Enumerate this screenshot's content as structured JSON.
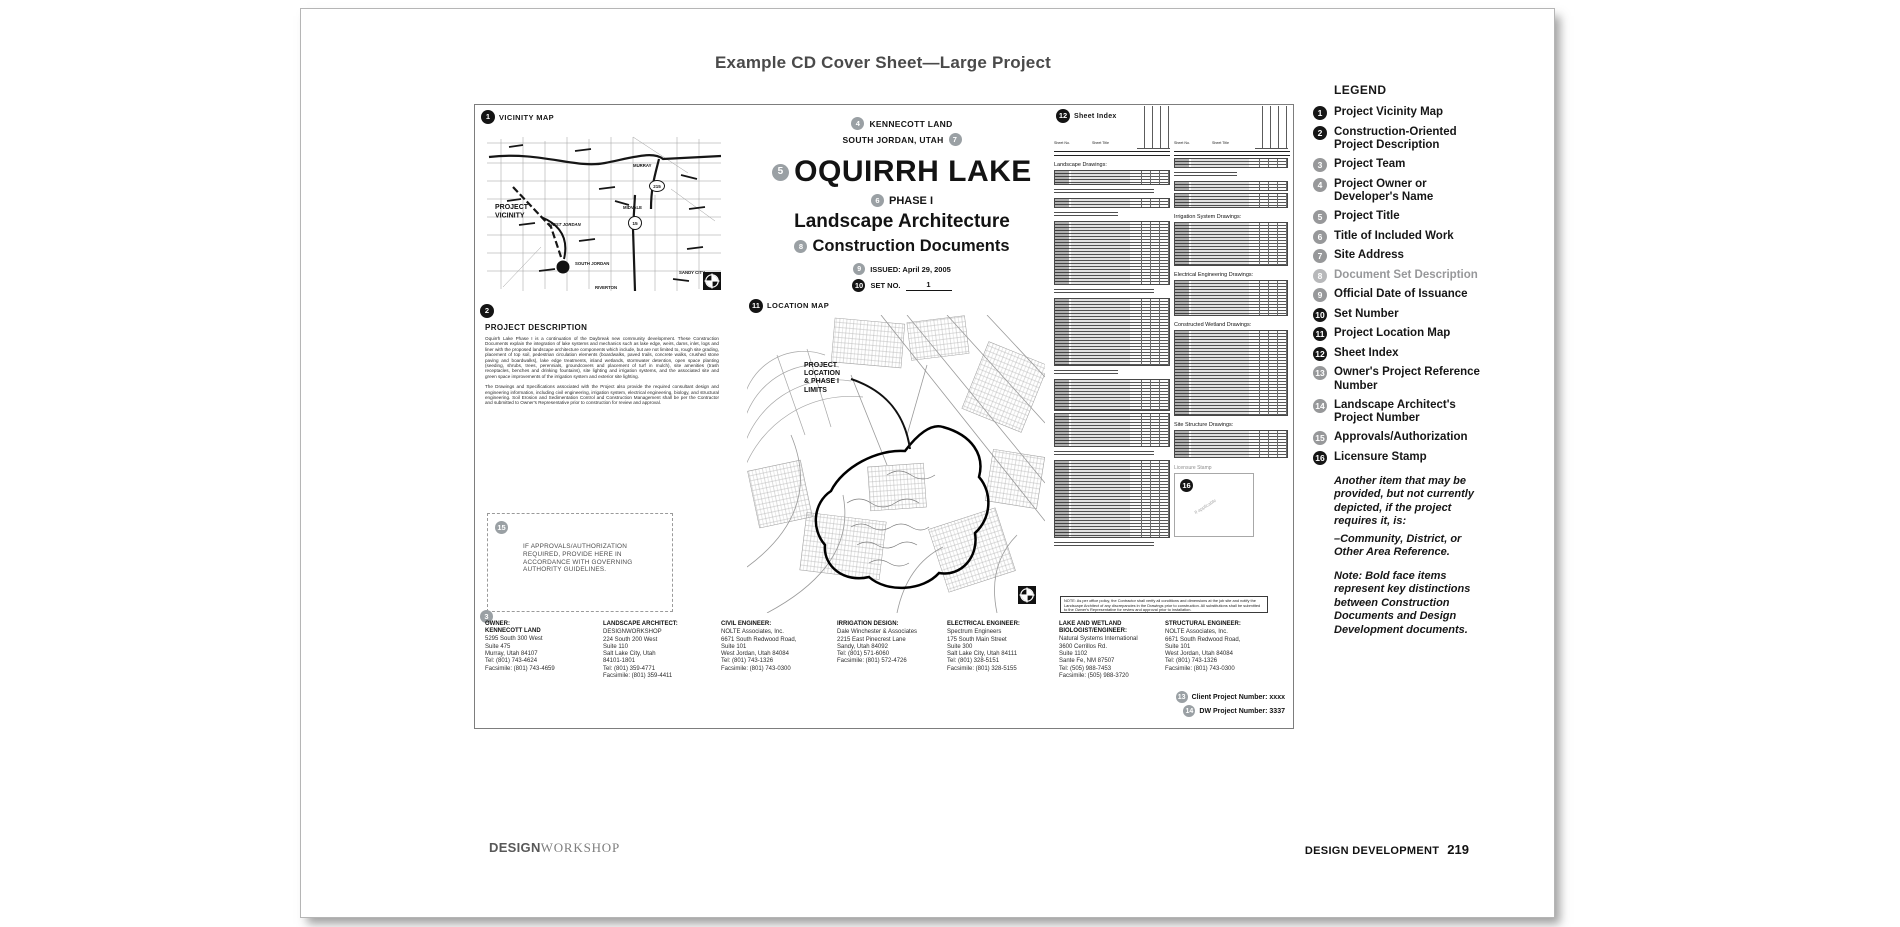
{
  "page_title": "Example CD Cover Sheet—Large Project",
  "sheet": {
    "vicinity": {
      "number": "1",
      "title": "VICINITY MAP",
      "callout": "PROJECT\nVICINITY",
      "labels": {
        "murray": "MURRAY",
        "midvale": "MIDVALE",
        "west_jordan": "WEST JORDAN",
        "south_jordan": "SOUTH JORDAN",
        "sandy_city": "SANDY CITY",
        "riverton": "RIVERTON",
        "route_215": "215",
        "route_15": "15"
      }
    },
    "description": {
      "number": "2",
      "title": "PROJECT DESCRIPTION",
      "para1": "Oquirrh Lake Phase I is a continuation of the Daybreak new community development. These Construction Documents explain the integration of lake systems and mechanics such as lake edge, weirs, dams, inlet, logs and liner with the proposed landscape architecture components which include, but are not limited to, rough site grading, placement of top soil, pedestrian circulation elements (boardwalks, paved trails, concrete walks, crushed stone paving and boardwalks), lake edge treatments, inland wetlands, stormwater detention, open space planting (seeding, shrubs, trees, perennials, groundcovers and placement of turf in mulch), site amenities (trash receptacles, benches and drinking fountains), site lighting and irrigation systems, and the associated site and green space improvements of the irrigation system and exterior site lighting.",
      "para2": "The Drawings and Specifications associated with the Project also provide the required consultant design and engineering information, including civil engineering, irrigation system, electrical engineering, biology, and structural engineering. Soil Erosion and Sedimentation Control and Construction Management shall be per the Contractor and submitted to Owner's Representative prior to construction for review and approval."
    },
    "title_block": {
      "owner_number": "4",
      "owner": "KENNECOTT LAND",
      "address": "SOUTH JORDAN, UTAH",
      "address_number": "7",
      "title_number": "5",
      "project_title": "OQUIRRH LAKE",
      "phase_number": "6",
      "phase": "PHASE I",
      "work_title": "Landscape Architecture",
      "set_desc_number": "8",
      "set_description": "Construction Documents",
      "issued_number": "9",
      "issued": "ISSUED: April 29, 2005",
      "set_no_number": "10",
      "set_no_label": "SET NO.",
      "set_no_value": "1"
    },
    "location_map": {
      "number": "11",
      "title": "LOCATION MAP",
      "callout": "PROJECT\nLOCATION\n& PHASE I\nLIMITS"
    },
    "sheet_index": {
      "number": "12",
      "title": "Sheet Index",
      "col_no": "Sheet No.",
      "col_title": "Sheet Title",
      "sections": {
        "landscape": "Landscape Drawings:",
        "irrigation": "Irrigation System Drawings:",
        "electrical": "Electrical Engineering Drawings:",
        "wetland": "Constructed Wetland Drawings:",
        "site_structure": "Site Structure Drawings:"
      },
      "note": "NOTE: As per office policy, the Contractor shall verify all conditions and dimensions at the job site and notify the Landscape Architect of any discrepancies in the Drawings prior to construction. All substitutions shall be submitted to the Owner's Representative for review and approval prior to installation."
    },
    "approvals": {
      "number": "15",
      "text": "IF APPROVALS/AUTHORIZATION\nREQUIRED, PROVIDE HERE IN\nACCORDANCE WITH GOVERNING\nAUTHORITY GUIDELINES."
    },
    "licensure": {
      "label": "Licensure Stamp",
      "number": "16",
      "placeholder": "If applicable"
    },
    "team": {
      "number": "3",
      "columns": [
        {
          "role": "OWNER:\nKENNECOTT LAND",
          "lines": "5295 South 300 West\nSuite 475\nMurray, Utah 84107\nTel: (801) 743-4624\nFacsimile: (801) 743-4659"
        },
        {
          "role": "LANDSCAPE ARCHITECT:",
          "lines": "DESIGNWORKSHOP\n224 South 200 West\nSuite 110\nSalt Lake City, Utah\n84101-1801\nTel: (801) 359-4771\nFacsimile: (801) 359-4411"
        },
        {
          "role": "CIVIL ENGINEER:",
          "lines": "NOLTE Associates, Inc.\n6671 South Redwood Road,\nSuite 101\nWest Jordan, Utah 84084\nTel: (801) 743-1326\nFacsimile: (801) 743-0300"
        },
        {
          "role": "IRRIGATION DESIGN:",
          "lines": "Dale Winchester & Associates\n2215 East Pinecrest Lane\nSandy, Utah 84092\nTel: (801) 571-6060\nFacsimile: (801) 572-4726"
        },
        {
          "role": "ELECTRICAL ENGINEER:",
          "lines": "Spectrum Engineers\n175 South Main Street\nSuite 300\nSalt Lake City, Utah 84111\nTel: (801) 328-5151\nFacsimile: (801) 328-5155"
        },
        {
          "role": "LAKE AND WETLAND\nBIOLOGIST/ENGINEER:",
          "lines": "Natural Systems International\n3600 Cerrillos Rd.\nSuite 1102\nSante Fe, NM 87507\nTel: (505) 988-7453\nFacsimile: (505) 988-3720"
        },
        {
          "role": "STRUCTURAL ENGINEER:",
          "lines": "NOLTE Associates, Inc.\n6671 South Redwood Road,\nSuite 101\nWest Jordan, Utah 84084\nTel: (801) 743-1326\nFacsimile: (801) 743-0300"
        }
      ]
    },
    "project_numbers": {
      "client_number": "13",
      "client": "Client Project Number: xxxx",
      "dw_number": "14",
      "dw": "DW Project Number: 3337"
    }
  },
  "legend": {
    "title": "LEGEND",
    "items": [
      {
        "n": "1",
        "label": "Project Vicinity Map",
        "tone": "b"
      },
      {
        "n": "2",
        "label": "Construction-Oriented Project Description",
        "tone": "b"
      },
      {
        "n": "3",
        "label": "Project Team",
        "tone": "g"
      },
      {
        "n": "4",
        "label": "Project Owner or Developer's Name",
        "tone": "g"
      },
      {
        "n": "5",
        "label": "Project Title",
        "tone": "g"
      },
      {
        "n": "6",
        "label": "Title of Included Work",
        "tone": "g"
      },
      {
        "n": "7",
        "label": "Site Address",
        "tone": "g"
      },
      {
        "n": "8",
        "label": "Document Set Description",
        "tone": "l"
      },
      {
        "n": "9",
        "label": "Official Date of Issuance",
        "tone": "g"
      },
      {
        "n": "10",
        "label": "Set Number",
        "tone": "b"
      },
      {
        "n": "11",
        "label": "Project Location Map",
        "tone": "b"
      },
      {
        "n": "12",
        "label": "Sheet Index",
        "tone": "b"
      },
      {
        "n": "13",
        "label": "Owner's Project Reference Number",
        "tone": "g"
      },
      {
        "n": "14",
        "label": "Landscape Architect's Project Number",
        "tone": "g"
      },
      {
        "n": "15",
        "label": "Approvals/Authorization",
        "tone": "g"
      },
      {
        "n": "16",
        "label": "Licensure Stamp",
        "tone": "b"
      }
    ],
    "note1": "Another item that may be provided, but not currently depicted, if the project requires it, is:",
    "note2": "–Community, District, or Other Area Reference.",
    "note3_prefix": "Note: ",
    "note3_bold": "Bold face",
    "note3_rest": " items represent key distinctions between Construction Documents and Design Development documents."
  },
  "footer": {
    "brand_bold": "DESIGN",
    "brand_serif": "WORKSHOP",
    "right_label": "DESIGN DEVELOPMENT",
    "page_number": "219"
  }
}
